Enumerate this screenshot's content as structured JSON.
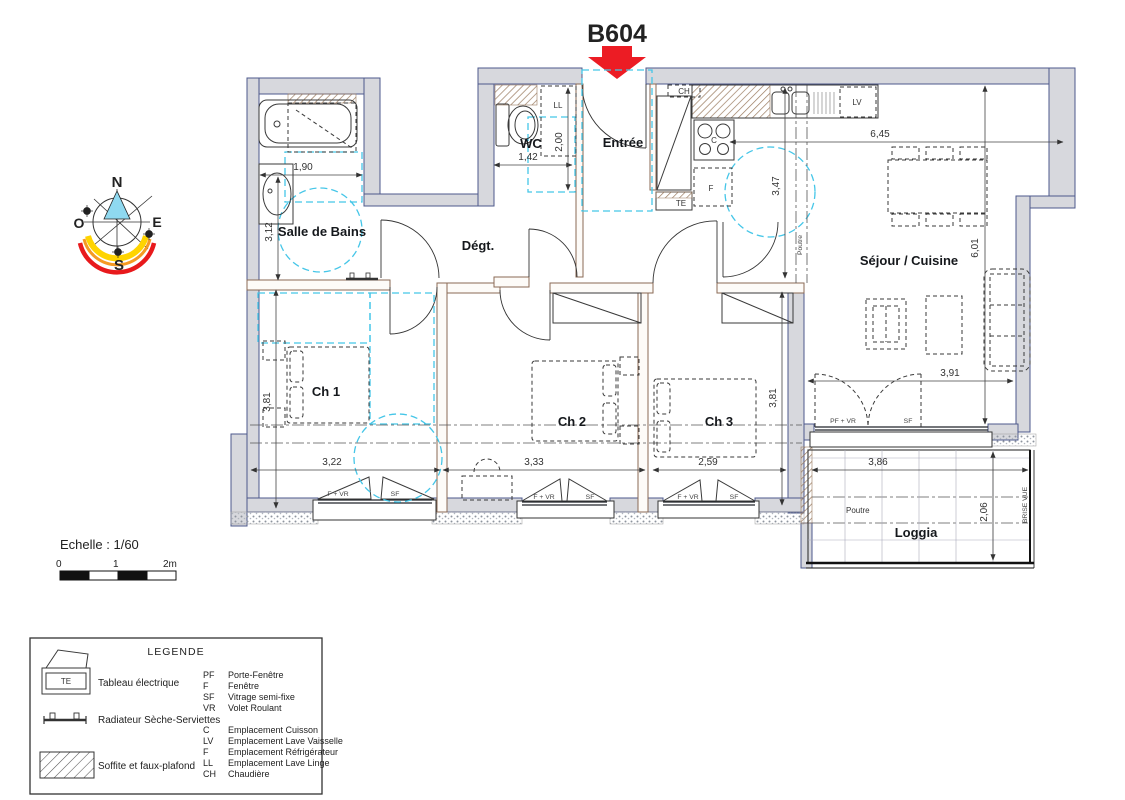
{
  "title": "B604",
  "compass": {
    "n": "N",
    "o": "O",
    "e": "E",
    "s": "S"
  },
  "rooms": {
    "bathroom": "Salle de Bains",
    "wc": "WC",
    "entry": "Entrée",
    "hall": "Dégt.",
    "living": "Séjour / Cuisine",
    "bedroom1": "Ch 1",
    "bedroom2": "Ch 2",
    "bedroom3": "Ch 3",
    "loggia": "Loggia"
  },
  "dims": {
    "bath_w": "1,90",
    "bath_h": "3,12",
    "wc_w": "1,42",
    "wc_h": "2,00",
    "living_w": "6,45",
    "kitchen_h": "3,47",
    "living_h": "6,01",
    "ch1_h": "3,81",
    "ch3_h": "3,81",
    "door_w": "3,91",
    "ch1_w": "3,22",
    "ch2_w": "3,33",
    "ch3_w": "2,59",
    "loggia_w": "3,86",
    "loggia_h": "2,06"
  },
  "annotations": {
    "ll": "LL",
    "ch": "CH",
    "te": "TE",
    "c": "C",
    "f": "F",
    "lv": "LV",
    "poutre": "Poutre",
    "brise_vue": "BRISE VUE",
    "f_vr": "F + VR",
    "pf_vr": "PF + VR",
    "sf": "SF"
  },
  "scale": {
    "label": "Echelle : 1/60",
    "t0": "0",
    "t1": "1",
    "t2": "2m"
  },
  "legend": {
    "title": "LEGENDE",
    "te_symbol": "TE",
    "items": [
      {
        "label": "Tableau électrique"
      },
      {
        "label": "Radiateur Sèche-Serviettes"
      },
      {
        "label": "Soffite et faux-plafond"
      }
    ],
    "abbreviations": [
      {
        "abbr": "PF",
        "label": "Porte-Fenêtre"
      },
      {
        "abbr": "F",
        "label": "Fenêtre"
      },
      {
        "abbr": "SF",
        "label": "Vitrage semi-fixe"
      },
      {
        "abbr": "VR",
        "label": "Volet Roulant"
      },
      {
        "abbr": "C",
        "label": "Emplacement Cuisson"
      },
      {
        "abbr": "LV",
        "label": "Emplacement Lave Vaisselle"
      },
      {
        "abbr": "F",
        "label": "Emplacement Réfrigérateur"
      },
      {
        "abbr": "LL",
        "label": "Emplacement Lave Linge"
      },
      {
        "abbr": "CH",
        "label": "Chaudière"
      }
    ]
  },
  "colors": {
    "accent_red": "#ec1c24",
    "cyan": "#45c6e8",
    "wall_gray": "#d7d8dd"
  }
}
